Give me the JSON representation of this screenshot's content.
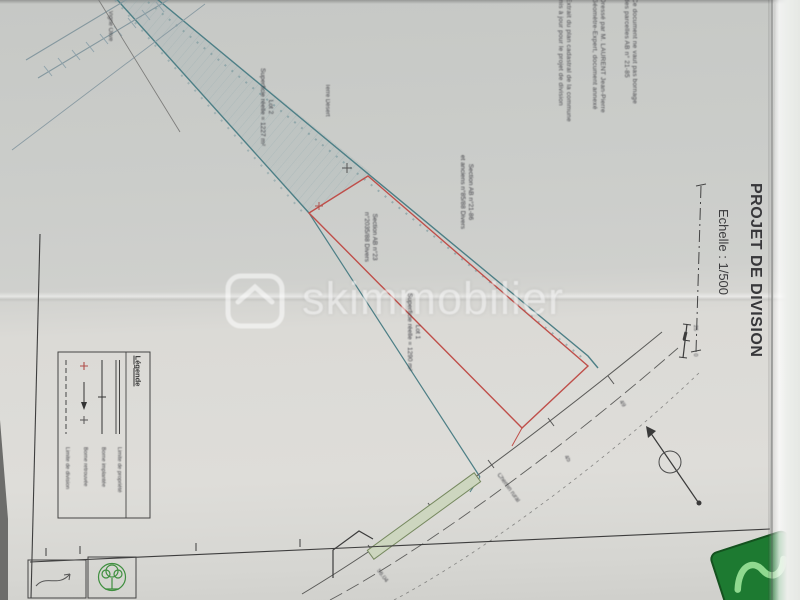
{
  "document": {
    "title": "PROJET DE DIVISION",
    "scale": "Echelle : 1/500",
    "watermark": "skimmobilier",
    "colors": {
      "teal_boundary": "#4d7f86",
      "red_boundary": "#bf4f4a",
      "green_strip": "#76895f",
      "stamp_green": "#3f8f3f",
      "logo_green": "#1d7a31"
    }
  },
  "parcels": {
    "lot1": {
      "name": "Lot 1",
      "area": "Superficie réelle = 1290 m²"
    },
    "lot2": {
      "name": "Lot 2",
      "area": "Superficie réelle = 1227 m²"
    }
  },
  "sections": {
    "s1": {
      "line1": "Section AB n°23",
      "line2": "n°2035/88 Divers"
    },
    "s2": {
      "line1": "Section AB n°21-86",
      "line2": "et anciens n°85/88 Divers"
    }
  },
  "places": {
    "p1": "Vigne Olive",
    "p2": "Terre Désert",
    "road": "Chemin rural"
  },
  "measurements": {
    "m1": "45",
    "m2": "49",
    "m3": "56.04",
    "scale_start": "0",
    "scale_mid": "25"
  },
  "legend": {
    "title": "Légende",
    "entries": [
      {
        "symbol": "dashed-line",
        "label": "Limite de division"
      },
      {
        "symbol": "red-cross-arrow",
        "label": "Borne retrouvée"
      },
      {
        "symbol": "line-tick",
        "label": "Borne implantée"
      },
      {
        "symbol": "double-line",
        "label": "Limite de propriété"
      }
    ]
  },
  "notes": {
    "n1a": "Extrait du plan cadastral de la commune",
    "n1b": "mis à jour pour le projet de division",
    "n2a": "Dressé par M. LAURENT Jean-Pierre",
    "n2b": "Géomètre-Expert, document annexé",
    "n3a": "Ce document ne vaut pas bornage",
    "n3b": "des parcelles AB n° 21-85"
  }
}
